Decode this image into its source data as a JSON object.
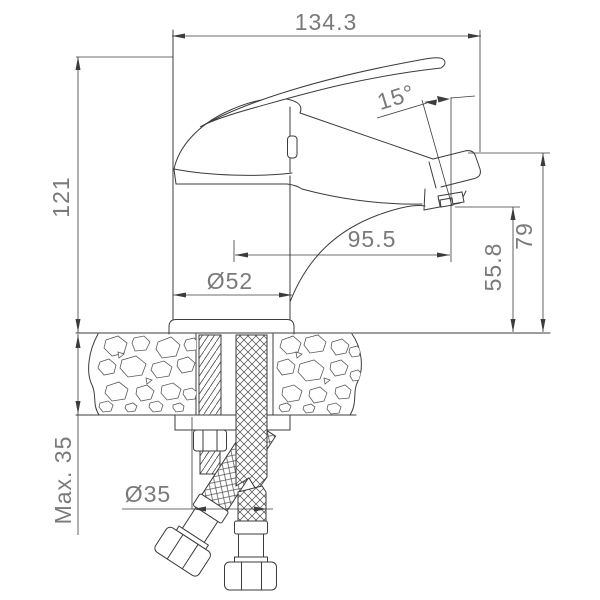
{
  "drawing": {
    "title": "basin mixer faucet installation drawing",
    "dimensions": {
      "total_width": "134.3",
      "overall_height": "121",
      "spout_angle": "15°",
      "spout_reach": "95.5",
      "base_diameter": "Ø52",
      "aerator_height": "55.8",
      "outlet_height": "79",
      "max_mounting_thickness": "Max. 35",
      "hole_diameter": "Ø35"
    },
    "colors": {
      "line": "#3c3c3c",
      "text": "#7a7a7a",
      "background": "#ffffff"
    }
  }
}
